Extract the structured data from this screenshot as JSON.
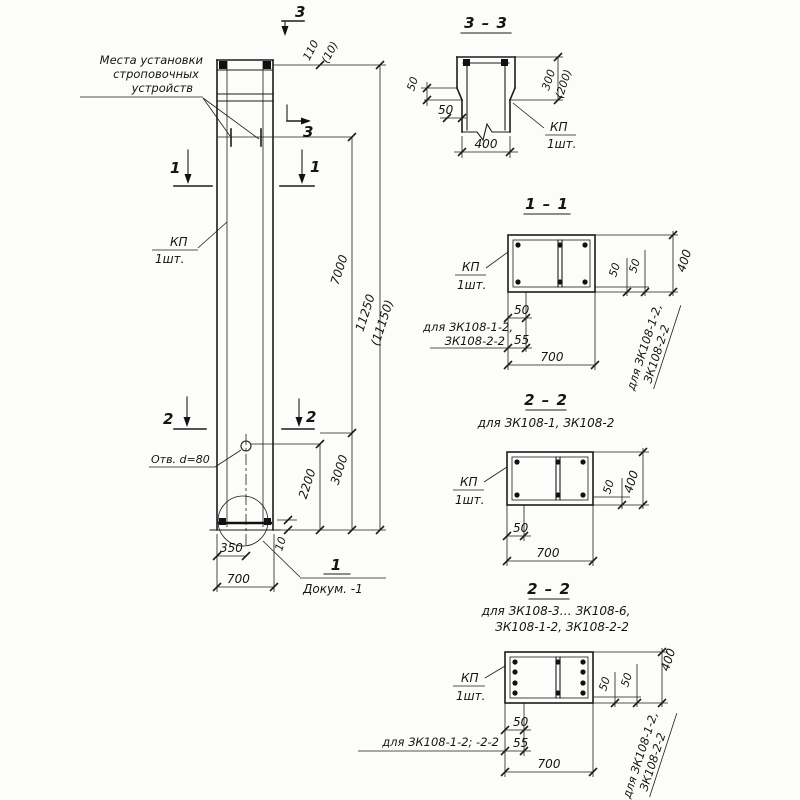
{
  "main": {
    "strop_note_l1": "Места установки",
    "strop_note_l2": "строповочных",
    "strop_note_l3": "устройств",
    "kp": "КП",
    "kp_qty": "1шт.",
    "hole_label": "Отв. d=80",
    "mark_1": "1",
    "mark_2": "2",
    "mark_3": "3",
    "dim_110": "110",
    "dim_110_alt": "(10)",
    "dim_7000": "7000",
    "dim_11250": "11250",
    "dim_11250_alt": "(11150)",
    "dim_3000": "3000",
    "dim_2200": "2200",
    "dim_10": "10",
    "dim_350": "350",
    "dim_700": "700",
    "detail_num": "1",
    "detail_ref": "Докум. -1"
  },
  "s33": {
    "title": "3 – 3",
    "dim_300": "300",
    "dim_200_alt": "(200)",
    "dim_50_left": "50",
    "dim_50_bot": "50",
    "dim_400": "400",
    "kp": "КП",
    "kp_qty": "1шт."
  },
  "s11": {
    "title": "1 – 1",
    "kp": "КП",
    "kp_qty": "1шт.",
    "dim_50": "50",
    "dim_55": "55",
    "dim_700": "700",
    "dim_50_r1": "50",
    "dim_50_r2": "50",
    "dim_400": "400",
    "note_l1": "для ЗК108-1-2,",
    "note_l2": "ЗК108-2-2",
    "note_r1": "для ЗК108-1-2,",
    "note_r2": "ЗК108-2-2"
  },
  "s22a": {
    "title": "2 – 2",
    "subtitle": "для ЗК108-1,  ЗК108-2",
    "kp": "КП",
    "kp_qty": "1шт.",
    "dim_50": "50",
    "dim_700": "700",
    "dim_50_r": "50",
    "dim_400": "400"
  },
  "s22b": {
    "title": "2 – 2",
    "subtitle_l1": "для ЗК108-3… ЗК108-6,",
    "subtitle_l2": "ЗК108-1-2,  ЗК108-2-2",
    "kp": "КП",
    "kp_qty": "1шт.",
    "dim_50": "50",
    "dim_55": "55",
    "dim_700": "700",
    "dim_50_r1": "50",
    "dim_50_r2": "50",
    "dim_400": "400",
    "note_left": "для ЗК108-1-2; -2-2",
    "note_r1": "для ЗК108-1-2,",
    "note_r2": "ЗК108-2-2"
  }
}
